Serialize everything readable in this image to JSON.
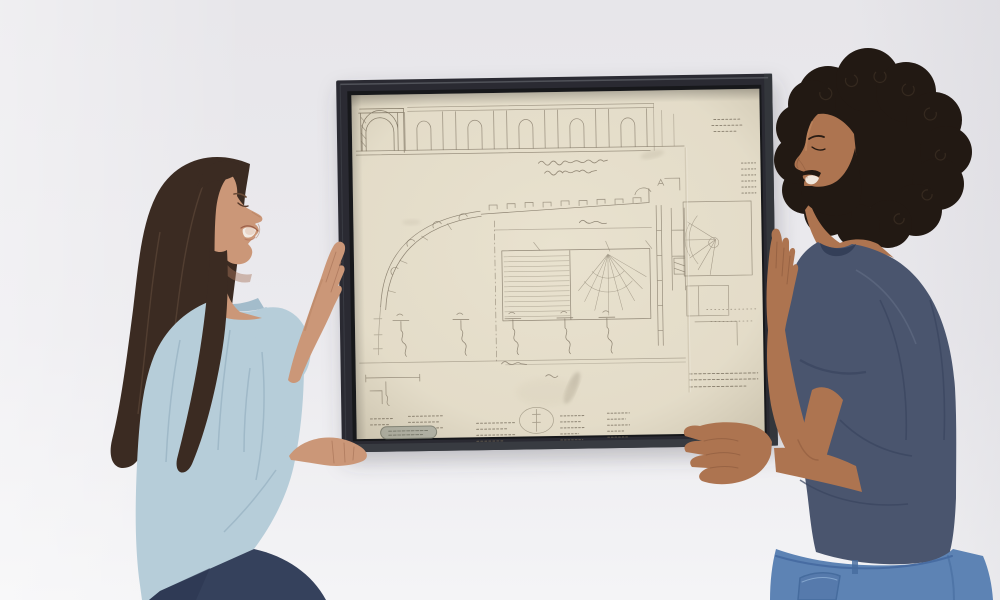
{
  "scene": {
    "description": "Two smiling people hold a large black-framed antique architectural sketch flat against a pale gray wall while hanging it together",
    "wall_color": "#eae9ed",
    "wall_color_bottom": "#f4f4f6"
  },
  "artwork": {
    "subject": "antique architectural plan and elevation sketch in graphite on cream paper",
    "frame_color": "#2a2c30",
    "frame_lip_color": "#17181b",
    "paper_color": "#e9e2cf",
    "ink_color": "#7c7261",
    "ink_faint_color": "#8d8270",
    "label_color": "#b9bbb0"
  },
  "woman": {
    "hair_color": "#3b2b22",
    "skin_color": "#cb9778",
    "shirt_color": "#b6cdd9",
    "jeans_color": "#35415c"
  },
  "man": {
    "hair_color": "#221913",
    "skin_color": "#ad7450",
    "shirt_color": "#4a556e",
    "jeans_color": "#5d83b4"
  }
}
